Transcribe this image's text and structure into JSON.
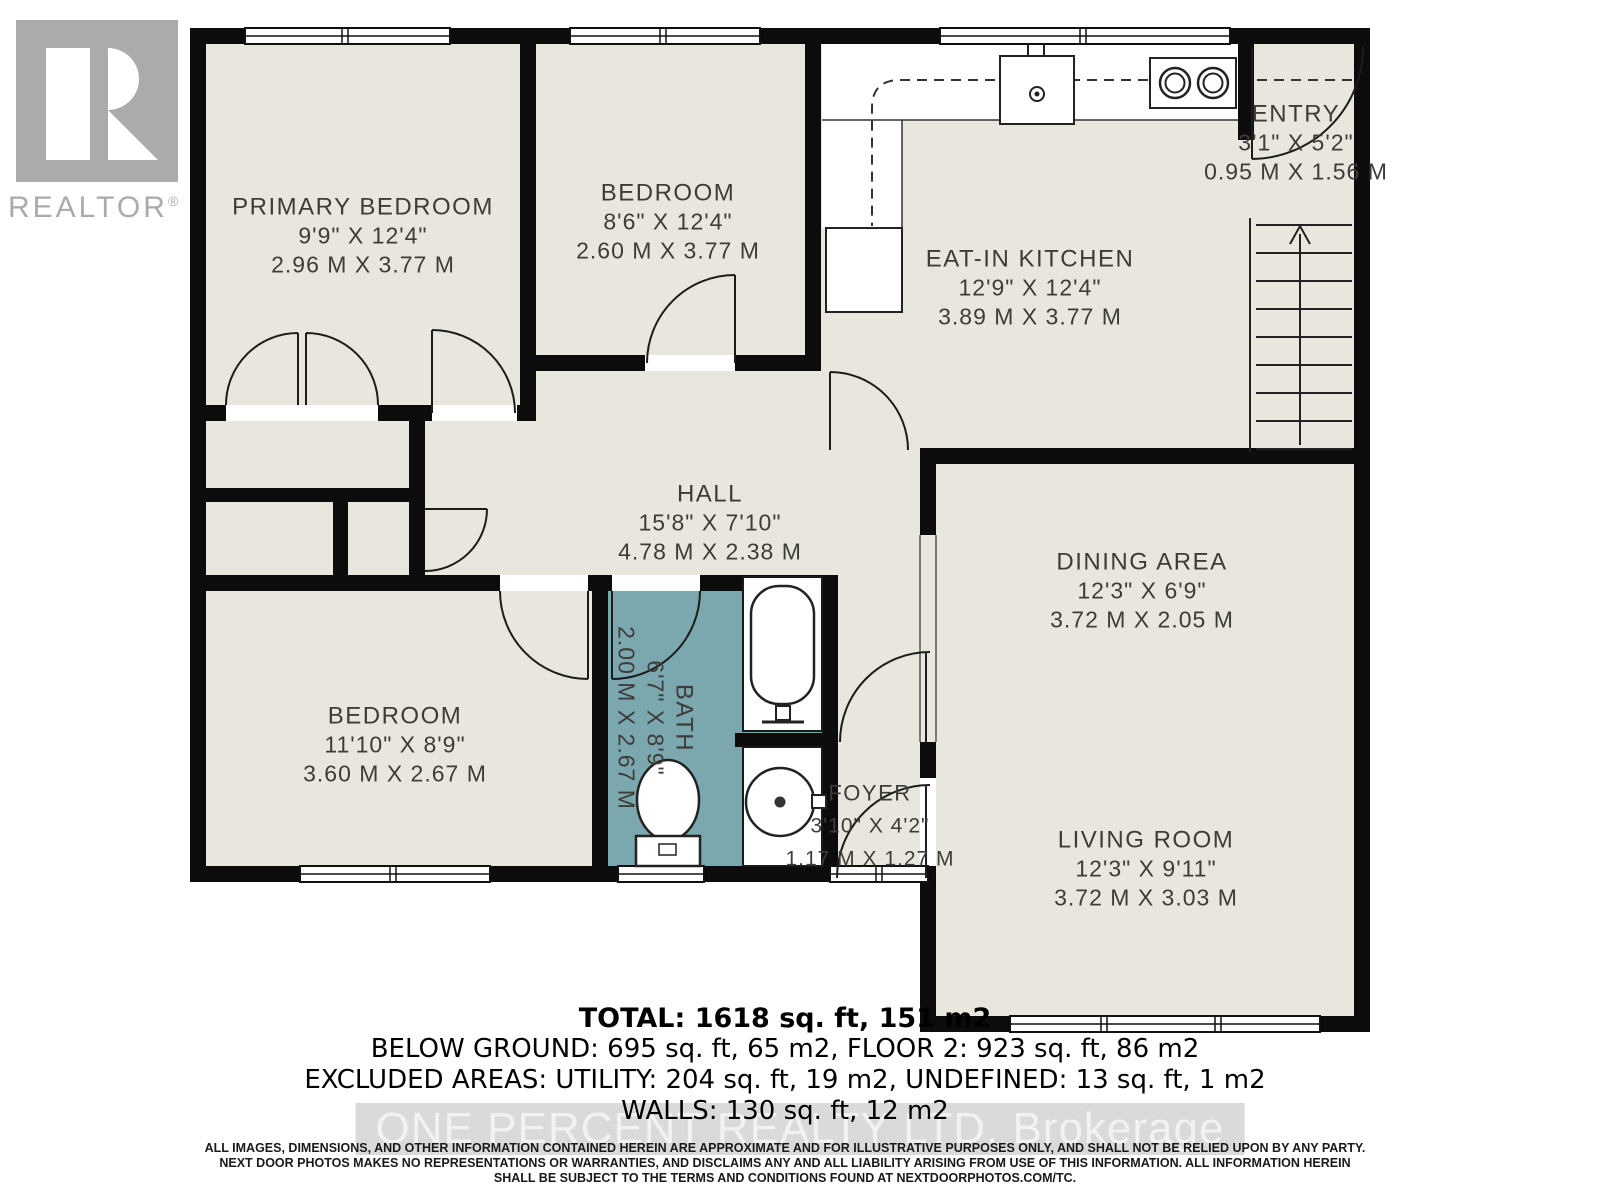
{
  "logo": {
    "brand": "REALTOR",
    "registered": "®"
  },
  "rooms": [
    {
      "name": "PRIMARY BEDROOM",
      "imperial": "9'9\" X 12'4\"",
      "metric": "2.96 M X 3.77 M"
    },
    {
      "name": "BEDROOM",
      "imperial": "8'6\" X 12'4\"",
      "metric": "2.60 M X 3.77 M"
    },
    {
      "name": "ENTRY",
      "imperial": "3'1\" X 5'2\"",
      "metric": "0.95 M X 1.56 M"
    },
    {
      "name": "EAT-IN KITCHEN",
      "imperial": "12'9\" X 12'4\"",
      "metric": "3.89 M X 3.77 M"
    },
    {
      "name": "HALL",
      "imperial": "15'8\" X 7'10\"",
      "metric": "4.78 M X 2.38 M"
    },
    {
      "name": "DINING AREA",
      "imperial": "12'3\" X 6'9\"",
      "metric": "3.72 M X 2.05 M"
    },
    {
      "name": "BEDROOM",
      "imperial": "11'10\" X 8'9\"",
      "metric": "3.60 M X 2.67 M"
    },
    {
      "name": "BATH",
      "imperial": "6'7\" X 8'9\"",
      "metric": "2.00 M X 2.67 M"
    },
    {
      "name": "FOYER",
      "imperial": "3'10\" X 4'2\"",
      "metric": "1.17 M X 1.27 M"
    },
    {
      "name": "LIVING ROOM",
      "imperial": "12'3\" X 9'11\"",
      "metric": "3.72 M X 3.03 M"
    }
  ],
  "summary": {
    "total": "TOTAL: 1618 sq. ft, 151 m2",
    "line2": "BELOW GROUND: 695 sq. ft, 65 m2, FLOOR 2: 923 sq. ft, 86 m2",
    "line3": "EXCLUDED AREAS: UTILITY: 204 sq. ft, 19 m2, UNDEFINED: 13 sq. ft, 1 m2",
    "line4": "WALLS: 130 sq. ft, 12 m2"
  },
  "watermark": "ONE PERCENT REALTY LTD. Brokerage",
  "disclaimer": {
    "line1": "ALL IMAGES, DIMENSIONS, AND OTHER INFORMATION CONTAINED HEREIN ARE APPROXIMATE AND FOR ILLUSTRATIVE PURPOSES ONLY, AND SHALL NOT BE RELIED UPON BY ANY PARTY.",
    "line2": "NEXT DOOR PHOTOS MAKES NO REPRESENTATIONS OR WARRANTIES, AND DISCLAIMS ANY AND ALL LIABILITY ARISING FROM USE OF THIS INFORMATION. ALL INFORMATION HEREIN",
    "line3": "SHALL BE SUBJECT TO THE TERMS AND CONDITIONS FOUND AT NEXTDOORPHOTOS.COM/TC."
  },
  "colors": {
    "floor": "#e9e7dd",
    "wall": "#0c0c0c",
    "bath": "#7ba7af",
    "logo_gray": "#ababab"
  }
}
